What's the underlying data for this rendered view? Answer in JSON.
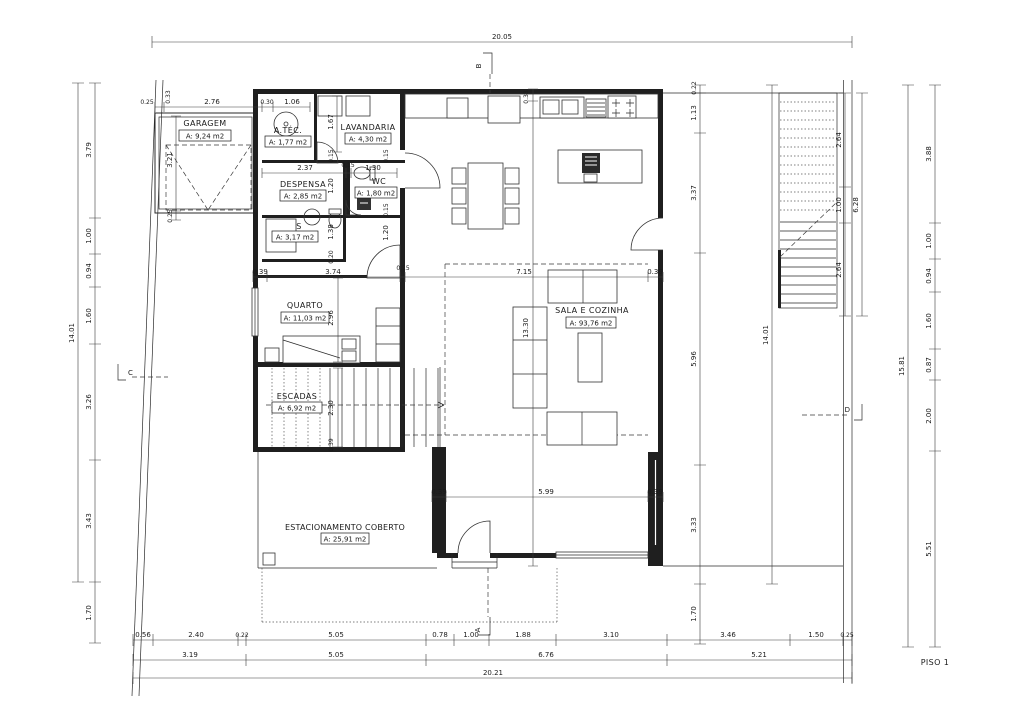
{
  "title": "PISO 1",
  "rooms": {
    "garagem": {
      "name": "GARAGEM",
      "area": "A: 9,24 m2"
    },
    "atec": {
      "name": "A.TÉC.",
      "area": "A: 1,77 m2"
    },
    "lavandaria": {
      "name": "LAVANDARIA",
      "area": "A: 4,30 m2"
    },
    "despensa": {
      "name": "DESPENSA",
      "area": "A: 2,85 m2"
    },
    "wc": {
      "name": "WC",
      "area": "A: 1,80 m2"
    },
    "s": {
      "name": "S",
      "area": "A: 3,17 m2"
    },
    "quarto": {
      "name": "QUARTO",
      "area": "A: 11,03 m2"
    },
    "escadas": {
      "name": "ESCADAS",
      "area": "A: 6,92 m2"
    },
    "sala": {
      "name": "SALA E COZINHA",
      "area": "A: 93,76 m2"
    },
    "estacionamento": {
      "name": "ESTACIONAMENTO COBERTO",
      "area": "A: 25,91 m2"
    }
  },
  "sections": {
    "a": "A",
    "b": "B",
    "c": "C",
    "d": "D"
  },
  "dims": {
    "top_total": "20.05",
    "bottom_total": "20.21",
    "left_total": "14.01",
    "left": [
      "3.79",
      "1.00",
      "0.94",
      "1.60",
      "3.26",
      "3.43",
      "1.70"
    ],
    "right_total": "14.01",
    "right": [
      "0.22",
      "1.13",
      "3.37",
      "5.96",
      "3.33",
      "1.70"
    ],
    "ext_stairs": [
      "2.64",
      "1.00",
      "2.64"
    ],
    "ext_stairs_total": "6.28",
    "far_right": [
      "3.88",
      "1.00",
      "0.94",
      "1.60",
      "0.87",
      "2.00",
      "5.51"
    ],
    "far_right_total": "15.81",
    "bottom1": [
      "0.56",
      "2.40",
      "0.22",
      "5.05",
      "0.78",
      "1.00",
      "1.88",
      "3.10",
      "3.46",
      "1.50",
      "0.25"
    ],
    "bottom2": [
      "3.19",
      "5.05",
      "6.76",
      "5.21"
    ],
    "garage": [
      "0.25",
      "2.76",
      "0.30",
      "1.06"
    ],
    "mid": [
      "0.39",
      "3.74",
      "0.15",
      "7.15",
      "0.39"
    ],
    "pantry": [
      "2.37",
      "0.15",
      "1.30"
    ],
    "carport": [
      "0.39",
      "5.99",
      "0.39"
    ],
    "v": {
      "a033": "0.33",
      "b033": "0.33",
      "g321": "3.21",
      "g025": "0.25",
      "l167": "1.67",
      "l015": "0.15",
      "l120": "1.20",
      "r015a": "0.15",
      "r015b": "0.15",
      "r120": "1.20",
      "s138": "1.38",
      "s020": "0.20",
      "q296": "2.96",
      "e230": "2.30",
      "sala1330": "13.30",
      "e039": "0.39"
    }
  }
}
